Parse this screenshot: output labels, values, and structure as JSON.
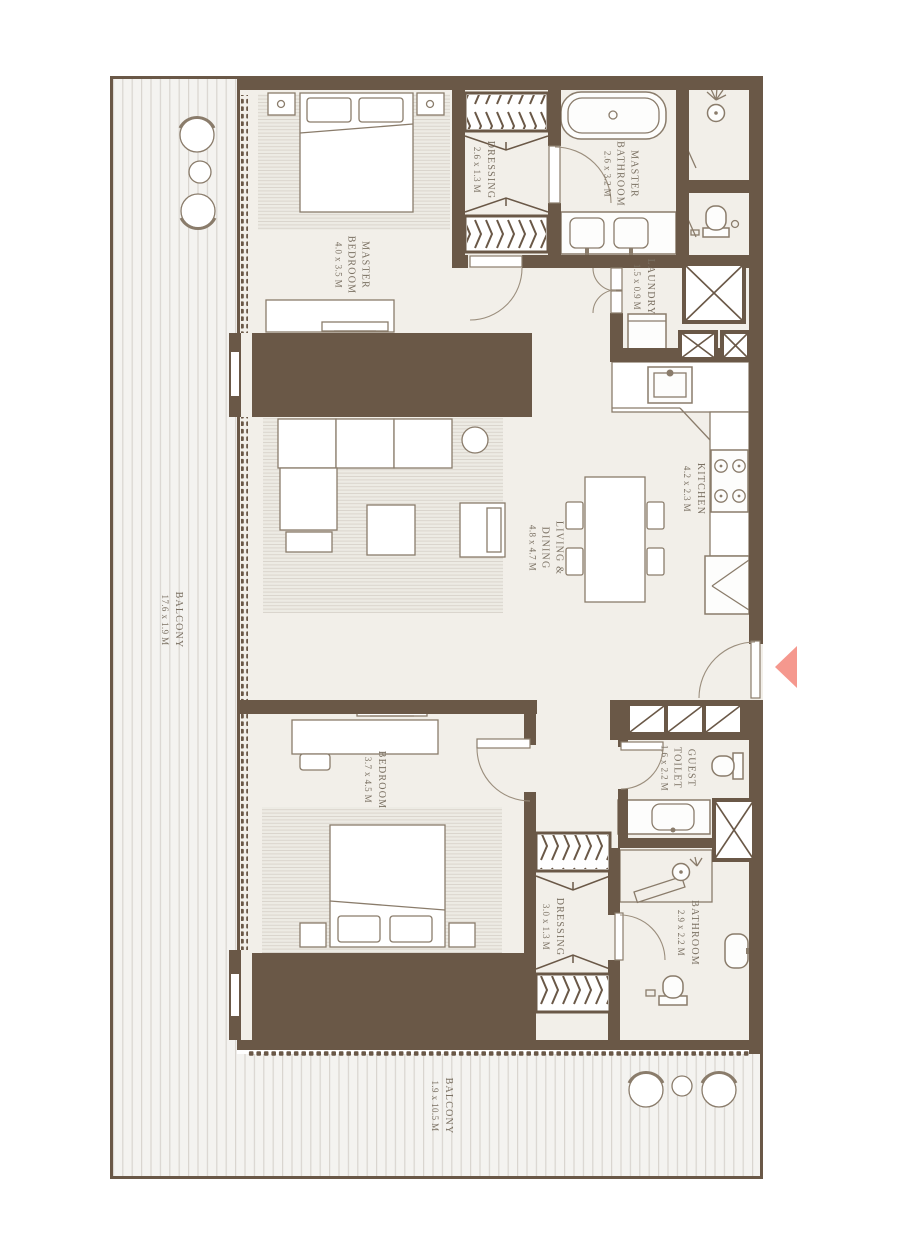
{
  "rooms": {
    "balcony_left": {
      "name": "BALCONY",
      "size": "17.6 x 1.9 M"
    },
    "master_bedroom": {
      "name": "MASTER\nBEDROOM",
      "size": "4.0 x 3.5 M"
    },
    "dressing_master": {
      "name": "DRESSING",
      "size": "2.6 x 1.3 M"
    },
    "master_bathroom": {
      "name": "MASTER\nBATHROOM",
      "size": "2.6 x 3.2 M"
    },
    "laundry": {
      "name": "LAUNDRY",
      "size": "1.5 x 0.9 M"
    },
    "kitchen": {
      "name": "KITCHEN",
      "size": "4.2 x 2.3 M"
    },
    "living_dining": {
      "name": "LIVING &\nDINING",
      "size": "4.8 x 4.7 M"
    },
    "bedroom": {
      "name": "BEDROOM",
      "size": "3.7 x 4.5 M"
    },
    "guest_toilet": {
      "name": "GUEST\nTOILET",
      "size": "1.6 x 2.2 M"
    },
    "dressing_bedroom": {
      "name": "DRESSING",
      "size": "3.0 x 1.3 M"
    },
    "bathroom": {
      "name": "BATHROOM",
      "size": "2.9 x 2.2 M"
    },
    "balcony_bottom": {
      "name": "BALCONY",
      "size": "1.9 x 10.5 M"
    }
  },
  "colors": {
    "wall": "#6a5847",
    "floor": "#f2efe9",
    "outline": "#8a7c6b",
    "label": "#7b7163",
    "arrow": "#f5988e"
  }
}
